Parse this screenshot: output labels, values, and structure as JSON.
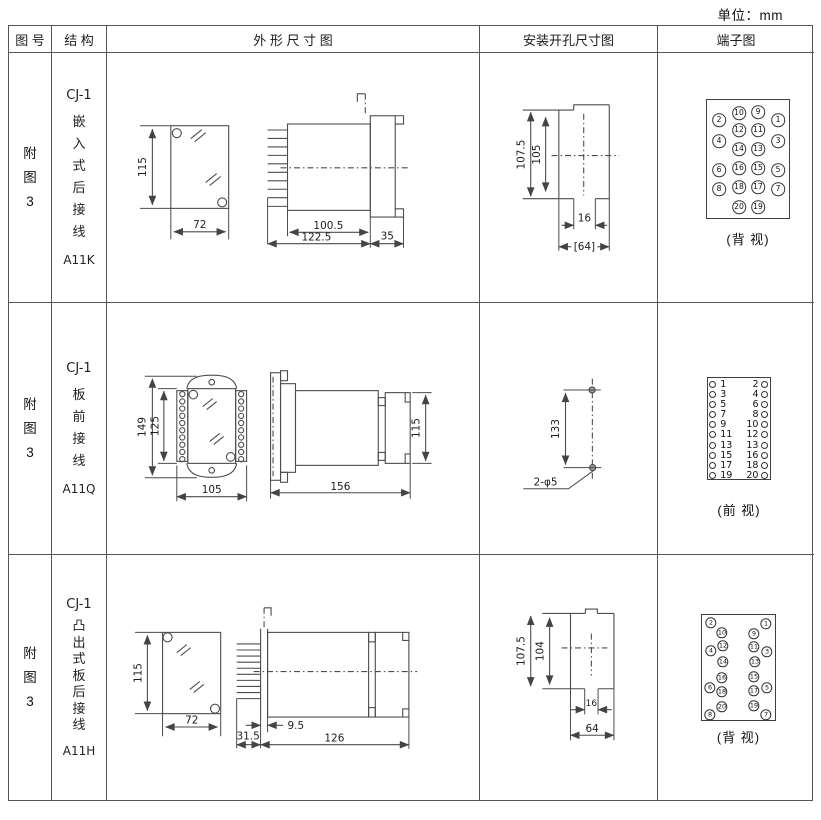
{
  "units_label": "单位：mm",
  "headers": {
    "fig_no": "图 号",
    "structure": "结 构",
    "outline": "外 形 尺 寸 图",
    "install": "安装开孔尺寸图",
    "terminal": "端子图"
  },
  "rows": [
    {
      "fig_no": "附\n图\n3",
      "model": "CJ-1",
      "mount": "嵌\n入\n式\n后\n接\n线",
      "code": "A11K",
      "outline_dims": {
        "height": "115",
        "width": "72",
        "body": "100.5",
        "total": "122.5",
        "flange": "35"
      },
      "install_dims": {
        "outer_h": "107.5",
        "inner_h": "105",
        "slot_w": "16",
        "width": "[64]"
      },
      "terminal": {
        "caption": "(背 视)",
        "points": [
          {
            "n": "2",
            "x": 12,
            "y": 20
          },
          {
            "n": "10",
            "x": 32,
            "y": 13
          },
          {
            "n": "9",
            "x": 51,
            "y": 12
          },
          {
            "n": "1",
            "x": 71,
            "y": 20
          },
          {
            "n": "4",
            "x": 12,
            "y": 41
          },
          {
            "n": "12",
            "x": 32,
            "y": 30
          },
          {
            "n": "11",
            "x": 51,
            "y": 30
          },
          {
            "n": "3",
            "x": 71,
            "y": 41
          },
          {
            "n": "14",
            "x": 32,
            "y": 49
          },
          {
            "n": "13",
            "x": 51,
            "y": 49
          },
          {
            "n": "6",
            "x": 12,
            "y": 70
          },
          {
            "n": "16",
            "x": 32,
            "y": 68
          },
          {
            "n": "15",
            "x": 51,
            "y": 68
          },
          {
            "n": "5",
            "x": 71,
            "y": 70
          },
          {
            "n": "8",
            "x": 12,
            "y": 89
          },
          {
            "n": "18",
            "x": 32,
            "y": 87
          },
          {
            "n": "17",
            "x": 51,
            "y": 87
          },
          {
            "n": "7",
            "x": 71,
            "y": 89
          },
          {
            "n": "20",
            "x": 32,
            "y": 107
          },
          {
            "n": "19",
            "x": 51,
            "y": 107
          }
        ]
      }
    },
    {
      "fig_no": "附\n图\n3",
      "model": "CJ-1",
      "mount": "板\n前\n接\n线",
      "code": "A11Q",
      "outline_dims": {
        "outer_h": "149",
        "inner_h": "125",
        "width": "105",
        "total": "156",
        "height": "115"
      },
      "install_dims": {
        "spacing": "133",
        "holes": "2-φ5"
      },
      "terminal": {
        "caption": "(前 视)",
        "pairs": [
          [
            "1",
            "2"
          ],
          [
            "3",
            "4"
          ],
          [
            "5",
            "6"
          ],
          [
            "7",
            "8"
          ],
          [
            "9",
            "10"
          ],
          [
            "11",
            "12"
          ],
          [
            "13",
            "13"
          ],
          [
            "15",
            "16"
          ],
          [
            "17",
            "18"
          ],
          [
            "19",
            "20"
          ]
        ]
      }
    },
    {
      "fig_no": "附\n图\n3",
      "model": "CJ-1",
      "mount": "凸\n出\n式\n板\n后\n接\n线",
      "code": "A11H",
      "outline_dims": {
        "height": "115",
        "width": "72",
        "pins": "31.5",
        "board": "9.5",
        "total": "126"
      },
      "install_dims": {
        "outer_h": "107.5",
        "inner_h": "104",
        "slot_w": "16",
        "width": "64"
      },
      "terminal": {
        "caption": "(背 视)",
        "points": [
          {
            "n": "2",
            "x": 9,
            "y": 8
          },
          {
            "n": "1",
            "x": 64,
            "y": 9
          },
          {
            "n": "10",
            "x": 20,
            "y": 18
          },
          {
            "n": "9",
            "x": 52,
            "y": 19
          },
          {
            "n": "12",
            "x": 21,
            "y": 31
          },
          {
            "n": "11",
            "x": 52,
            "y": 32
          },
          {
            "n": "4",
            "x": 9,
            "y": 36
          },
          {
            "n": "3",
            "x": 65,
            "y": 37
          },
          {
            "n": "14",
            "x": 21,
            "y": 47
          },
          {
            "n": "13",
            "x": 53,
            "y": 47
          },
          {
            "n": "16",
            "x": 20,
            "y": 63
          },
          {
            "n": "15",
            "x": 52,
            "y": 62
          },
          {
            "n": "6",
            "x": 8,
            "y": 73
          },
          {
            "n": "5",
            "x": 65,
            "y": 73
          },
          {
            "n": "18",
            "x": 20,
            "y": 77
          },
          {
            "n": "17",
            "x": 52,
            "y": 76
          },
          {
            "n": "20",
            "x": 20,
            "y": 92
          },
          {
            "n": "19",
            "x": 52,
            "y": 91
          },
          {
            "n": "8",
            "x": 8,
            "y": 100
          },
          {
            "n": "7",
            "x": 64,
            "y": 100
          }
        ]
      }
    }
  ]
}
